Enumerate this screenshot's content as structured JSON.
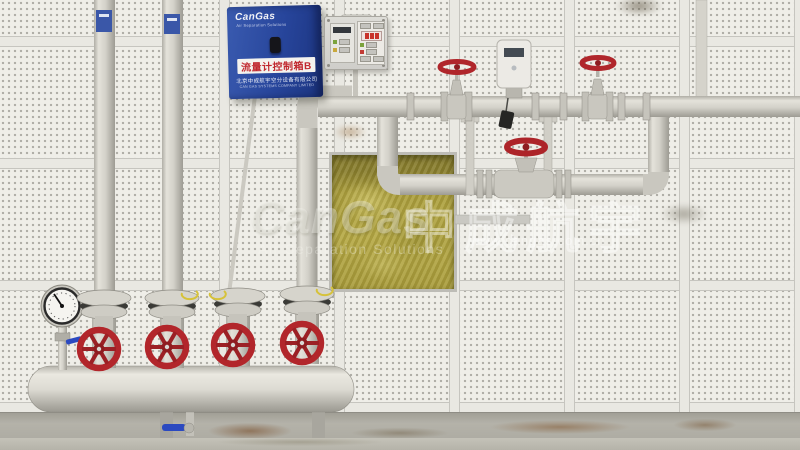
{
  "meta": {
    "type": "photograph",
    "subject": "Gas flow-meter piping and manifold on a white perforated acoustic panel wall"
  },
  "watermark": {
    "brand": "CanGas",
    "tagline": "Air Separation Solutions",
    "brand_cn": "中成航宇",
    "website": "www.cangas.com.cn"
  },
  "control_box": {
    "brand": "CanGas",
    "brand_tagline": "Air Separation Solutions",
    "label": "流量计控制箱B",
    "company_cn": "北京中成航宇空分设备有限公司",
    "company_en": "CAN GAS SYSTEMS COMPANY LIMITED"
  },
  "colors": {
    "wall": "#efeee8",
    "pipe": "#d2d0c8",
    "valve_wheel_red": "#b0262b",
    "insulation_yellow": "#aa9d3c",
    "control_box_blue": "#27459b",
    "handle_blue": "#2b49c0",
    "baseboard": "#aba9a0",
    "floor": "#b8b6ac"
  },
  "equipment_names": {
    "gauge": "pressure-gauge",
    "manifold": "manifold-header",
    "valve": "globe-valve-red-handwheel",
    "meter": "flow-transmitter",
    "panel": "alarm-control-panel"
  }
}
